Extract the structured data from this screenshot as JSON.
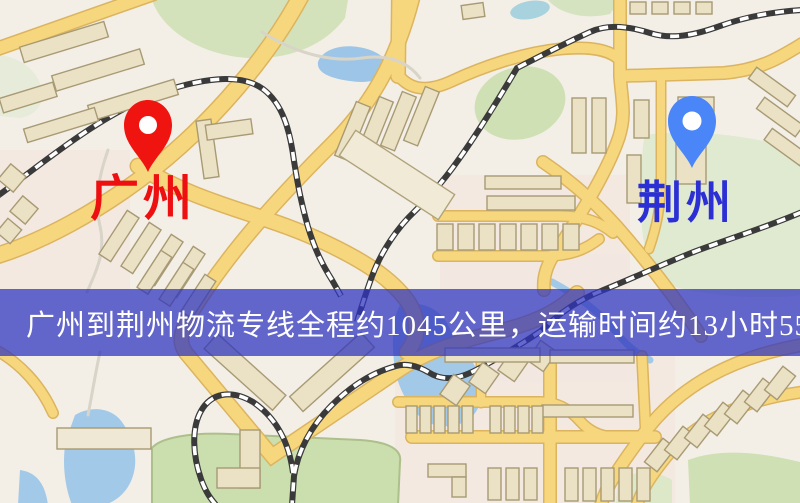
{
  "map": {
    "markers": {
      "origin": {
        "name": "广州",
        "pin_color": "#f01410",
        "label_color": "#ee1010"
      },
      "destination": {
        "name": "荆州",
        "pin_color": "#4a86f7",
        "label_color": "#2b2fd4"
      }
    },
    "banner": {
      "text": "广州到荆州物流专线全程约1045公里，运输时间约13小时55分钟.",
      "distance_text": "约1045公里",
      "duration_text": "约13小时55分钟",
      "background": "rgba(47,52,190,0.74)",
      "text_color": "#ffffff"
    },
    "palette": {
      "land": "#f3efe7",
      "road_fill": "#f6d77e",
      "road_casing": "#dcb45f",
      "building_fill": "#ebe2c6",
      "building_outline": "#a89a74",
      "green_area": "#cfe0b5",
      "water": "#a3c9e9",
      "railway": "#3a3a3a",
      "minor_path": "#d8d4c8"
    }
  }
}
